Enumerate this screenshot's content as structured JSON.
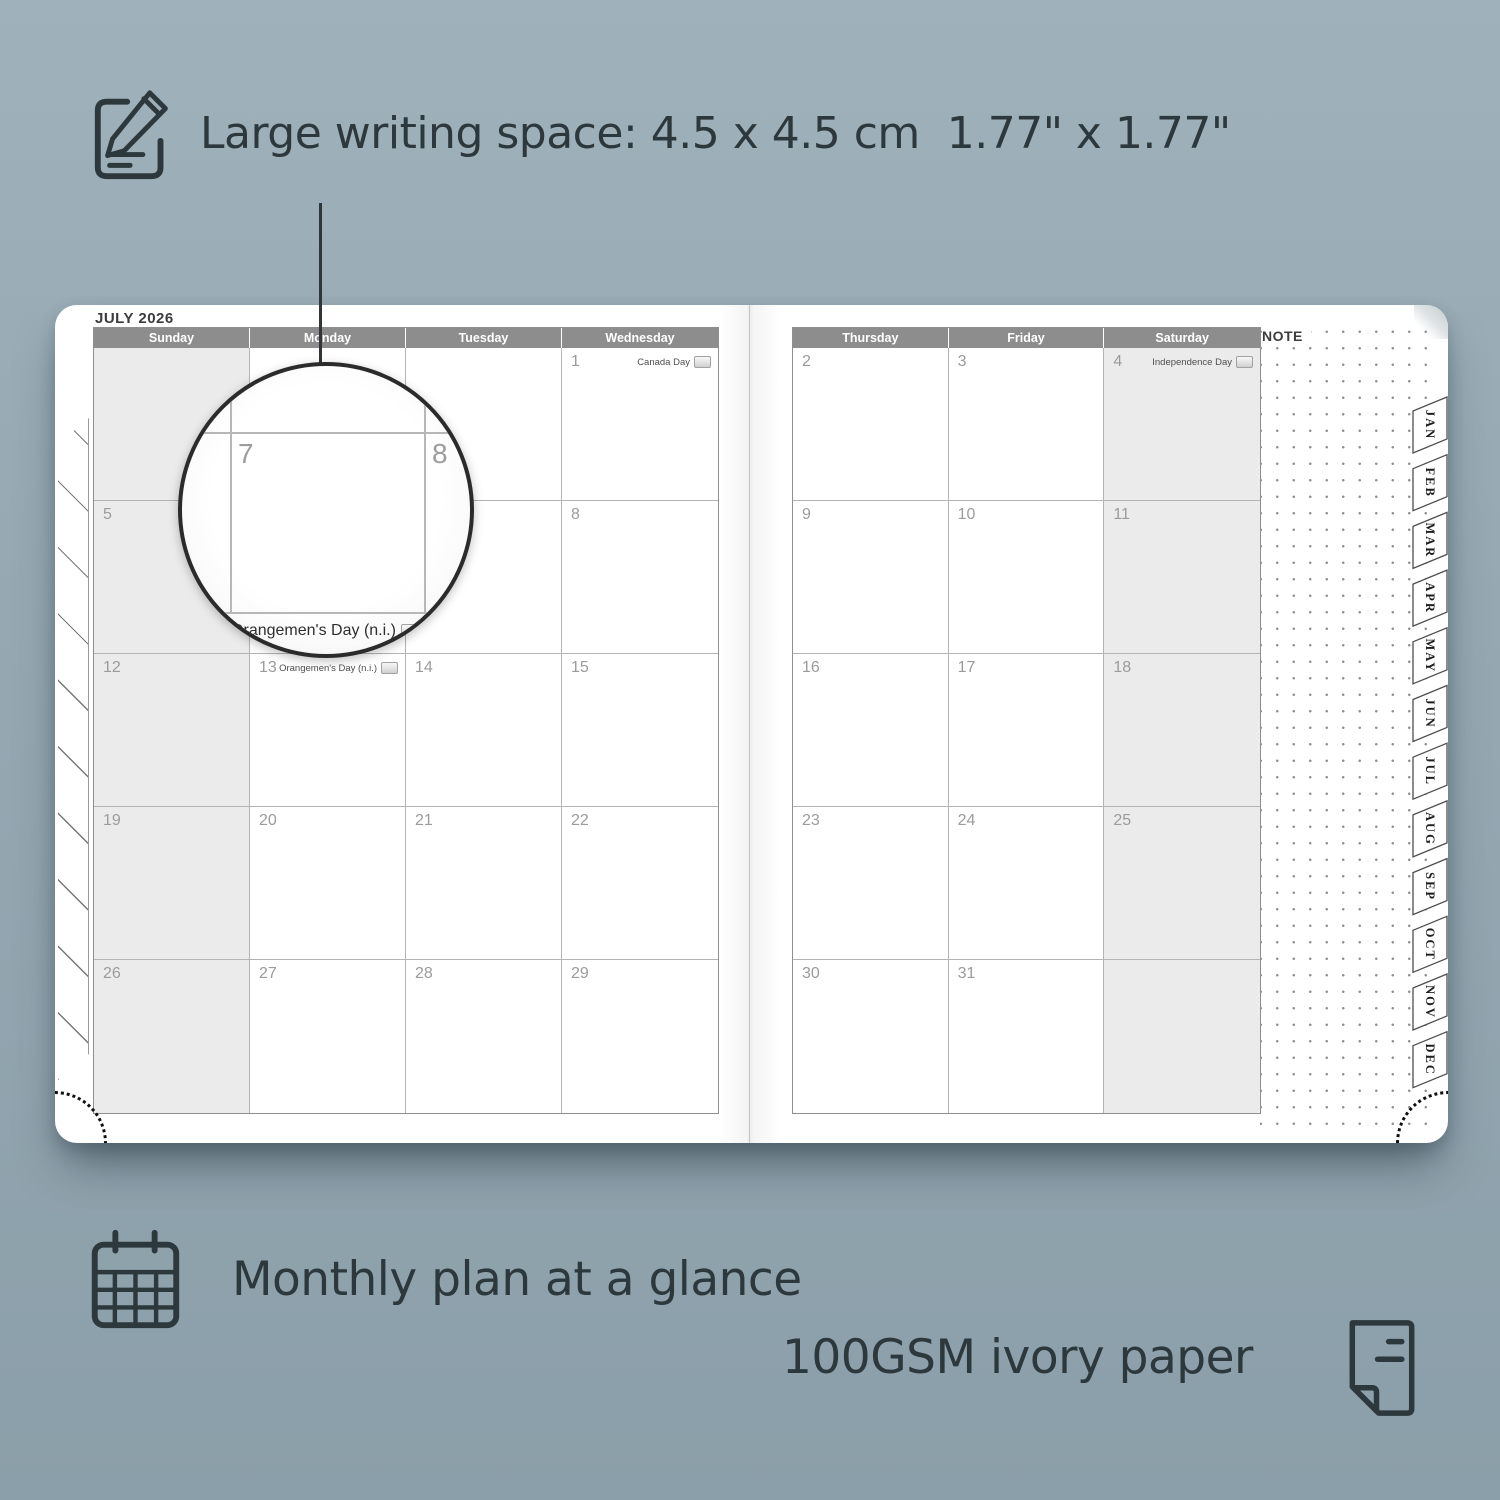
{
  "headline": {
    "text": "Large writing space: 4.5 x 4.5 cm  1.77\" x 1.77\""
  },
  "planner": {
    "month_title": "JULY 2026",
    "note_label": "NOTE",
    "left_day_headers": [
      "Sunday",
      "Monday",
      "Tuesday",
      "Wednesday"
    ],
    "right_day_headers": [
      "Thursday",
      "Friday",
      "Saturday"
    ],
    "month_tabs": [
      "JAN",
      "FEB",
      "MAR",
      "APR",
      "MAY",
      "JUN",
      "JUL",
      "AUG",
      "SEP",
      "OCT",
      "NOV",
      "DEC"
    ],
    "left_weeks": [
      [
        {
          "day": ""
        },
        {
          "day": ""
        },
        {
          "day": ""
        },
        {
          "day": "1",
          "holiday": "Canada Day",
          "badge": true
        }
      ],
      [
        {
          "day": "5"
        },
        {
          "day": "6"
        },
        {
          "day": "7"
        },
        {
          "day": "8"
        }
      ],
      [
        {
          "day": "12"
        },
        {
          "day": "13",
          "holiday": "Orangemen's Day (n.i.)",
          "badge": true
        },
        {
          "day": "14"
        },
        {
          "day": "15"
        }
      ],
      [
        {
          "day": "19"
        },
        {
          "day": "20"
        },
        {
          "day": "21"
        },
        {
          "day": "22"
        }
      ],
      [
        {
          "day": "26"
        },
        {
          "day": "27"
        },
        {
          "day": "28"
        },
        {
          "day": "29"
        }
      ]
    ],
    "right_weeks": [
      [
        {
          "day": "2"
        },
        {
          "day": "3"
        },
        {
          "day": "4",
          "holiday": "Independence Day",
          "badge": true
        }
      ],
      [
        {
          "day": "9"
        },
        {
          "day": "10"
        },
        {
          "day": "11"
        }
      ],
      [
        {
          "day": "16"
        },
        {
          "day": "17"
        },
        {
          "day": "18"
        }
      ],
      [
        {
          "day": "23"
        },
        {
          "day": "24"
        },
        {
          "day": "25"
        }
      ],
      [
        {
          "day": "30"
        },
        {
          "day": "31"
        },
        {
          "day": ""
        }
      ]
    ]
  },
  "magnifier": {
    "left_day": "7",
    "right_day": "8",
    "holiday": "Orangemen's Day (n.i.)"
  },
  "features": {
    "monthly": "Monthly plan at a glance",
    "paper": "100GSM ivory paper"
  },
  "colors": {
    "background": "#95a8b2",
    "ink": "#2d383c",
    "header_bar": "#8d8d8d",
    "shaded_cell": "#ebebeb",
    "page": "#ffffff"
  }
}
